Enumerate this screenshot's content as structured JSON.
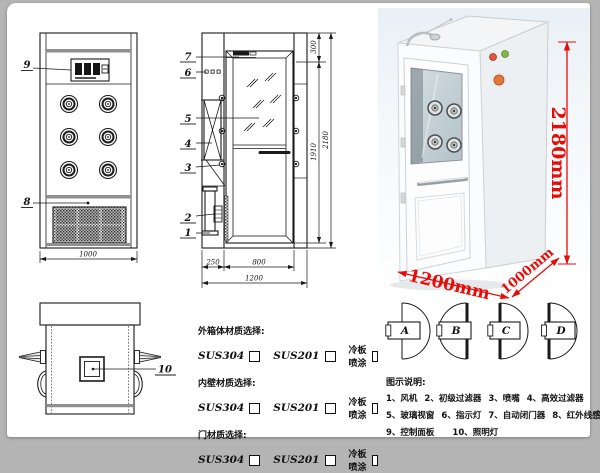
{
  "colors": {
    "dimension_red": "#e60d08",
    "line_black": "#1a1a1a",
    "band_gray": "#8f8f8f"
  },
  "drawing": {
    "front": {
      "callout_panel": "9",
      "callout_grille": "8",
      "dim_width": "1000"
    },
    "side": {
      "callouts": [
        "7",
        "6",
        "5",
        "4",
        "3",
        "2",
        "1"
      ],
      "dim_top": "300",
      "dim_inner": "1910",
      "dim_height": "2180",
      "dim_left": "250",
      "dim_door": "800",
      "dim_total": "1200"
    },
    "top": {
      "callout": "10"
    }
  },
  "photo": {
    "dim_height": "2180mm",
    "dim_width": "1200mm",
    "dim_depth": "1000mm"
  },
  "materials": {
    "groups": [
      {
        "label": "外箱体材质选择:",
        "opt1": "SUS304",
        "opt2": "SUS201",
        "opt3": "冷板喷涂"
      },
      {
        "label": "内壁材质选择:",
        "opt1": "SUS304",
        "opt2": "SUS201",
        "opt3": "冷板喷涂"
      },
      {
        "label": "门材质选择:",
        "opt1": "SUS304",
        "opt2": "SUS201",
        "opt3": "冷板喷涂"
      }
    ]
  },
  "doors": [
    "A",
    "B",
    "C",
    "D"
  ],
  "legend": {
    "title": "图示说明:",
    "row1": [
      "1、风机",
      "2、初级过滤器",
      "3、喷嘴",
      "4、高效过滤器"
    ],
    "row2": [
      "5、玻璃视窗",
      "6、指示灯",
      "7、自动闭门器",
      "8、红外线感应器"
    ],
    "row3": [
      "9、控制面板",
      "10、照明灯"
    ]
  }
}
